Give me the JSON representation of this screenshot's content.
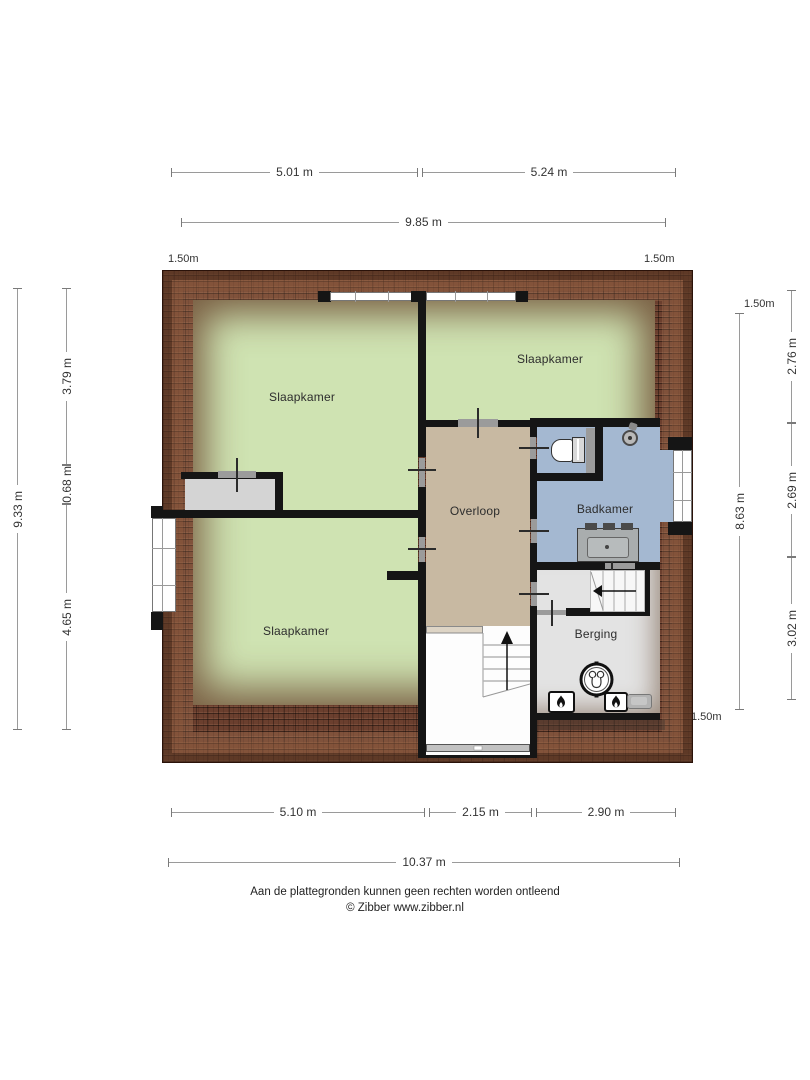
{
  "plan": {
    "rooms": [
      {
        "id": "slaapkamer-tl",
        "label": "Slaapkamer"
      },
      {
        "id": "slaapkamer-tr",
        "label": "Slaapkamer"
      },
      {
        "id": "slaapkamer-bl",
        "label": "Slaapkamer"
      },
      {
        "id": "overloop",
        "label": "Overloop"
      },
      {
        "id": "badkamer",
        "label": "Badkamer"
      },
      {
        "id": "berging",
        "label": "Berging"
      }
    ],
    "colors": {
      "bedroom_green": "#cfe3b2",
      "landing_tan": "#c8b9a2",
      "bathroom_blue": "#a4b8d1",
      "storage_gray": "#e3e3e3",
      "roof_brick": "#6b3f2e",
      "wall_black": "#151515"
    },
    "fixtures": [
      "toilet",
      "shower",
      "sink-vanity",
      "boiler",
      "heater",
      "heater",
      "stairs-main",
      "stairs-berging",
      "closet"
    ]
  },
  "dimensions": {
    "top": {
      "segments": [
        "5.01 m",
        "5.24 m"
      ],
      "total": "9.85 m"
    },
    "bottom": {
      "segments": [
        "5.10 m",
        "2.15 m",
        "2.90 m"
      ],
      "total": "10.37 m"
    },
    "left": {
      "segments": [
        "3.79 m",
        "0.68 m",
        "4.65 m"
      ],
      "total": "9.33 m"
    },
    "right": {
      "segments": [
        "2.76 m",
        "2.69 m",
        "3.02 m"
      ],
      "total": "8.63 m"
    },
    "height_markers": {
      "top_left": "1.50m",
      "top_right": "1.50m",
      "right_top": "1.50m",
      "bottom_right": "1.50m"
    }
  },
  "footer": {
    "disclaimer": "Aan de plattegronden kunnen geen rechten worden ontleend",
    "credit": "© Zibber www.zibber.nl"
  }
}
